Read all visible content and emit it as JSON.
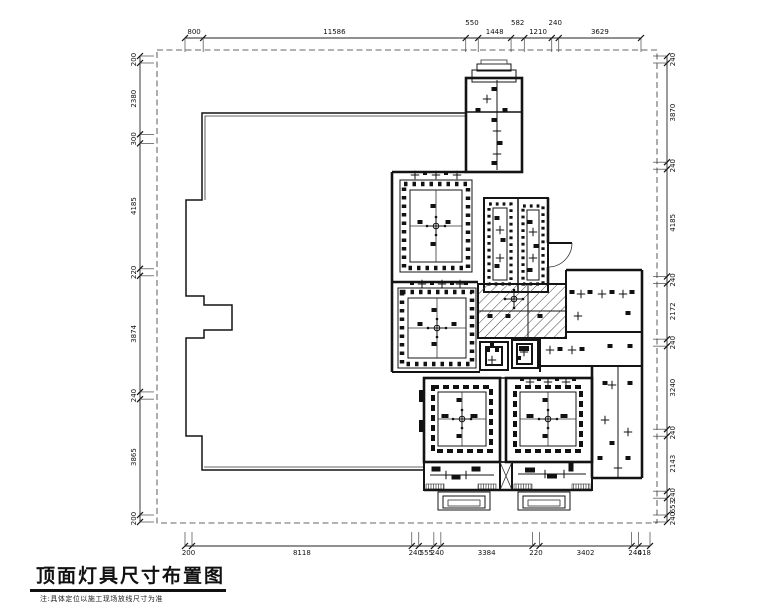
{
  "title": {
    "text": "顶面灯具尺寸布置图",
    "note": "注:具体定位以施工现场放线尺寸为准"
  },
  "dimensions": {
    "top": [
      "800",
      "11586",
      "550",
      "1448",
      "582",
      "1210",
      "240",
      "3629"
    ],
    "left": [
      "200",
      "2380",
      "300",
      "4185",
      "220",
      "3874",
      "240",
      "3865",
      "200"
    ],
    "right": [
      "240",
      "3870",
      "240",
      "4185",
      "240",
      "2172",
      "240",
      "3240",
      "240",
      "2143",
      "240",
      "653",
      "240"
    ],
    "bottom": [
      "200",
      "8118",
      "240",
      "555",
      "240",
      "3384",
      "220",
      "3402",
      "240",
      "418"
    ]
  },
  "colors": {
    "line": "#141414",
    "background": "#ffffff",
    "hatch": "#444444"
  }
}
